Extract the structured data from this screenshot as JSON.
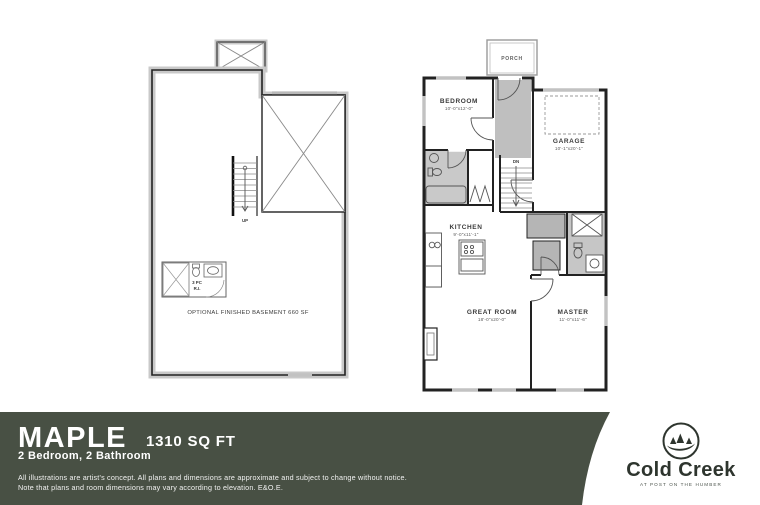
{
  "footer": {
    "model_name": "MAPLE",
    "sqft": "1310 SQ FT",
    "config": "2 Bedroom, 2 Bathroom",
    "disclaimer_line1": "All illustrations are artist's concept. All plans and dimensions are approximate and subject to change without notice.",
    "disclaimer_line2": "Note that plans and room dimensions may vary according to elevation. E&O.E."
  },
  "brand": {
    "name": "Cold Creek",
    "tagline": "AT POST ON THE HUMBER"
  },
  "basement_plan": {
    "bath_line1": "3 PC",
    "bath_line2": "R.I.",
    "stairs_label": "UP",
    "note": "OPTIONAL FINISHED BASEMENT 660 SF"
  },
  "main_plan": {
    "porch_label": "PORCH",
    "stairs_label": "DN",
    "rooms": {
      "bedroom": {
        "name": "BEDROOM",
        "dims": "10'-0\"x12'-0\""
      },
      "garage": {
        "name": "GARAGE",
        "dims": "10'-1\"x20'-1\""
      },
      "kitchen": {
        "name": "KITCHEN",
        "dims": "9'-0\"x11'-1\""
      },
      "great_room": {
        "name": "GREAT ROOM",
        "dims": "18'-0\"x20'-0\""
      },
      "master": {
        "name": "MASTER",
        "dims": "11'-0\"x11'-6\""
      }
    }
  },
  "colors": {
    "footer_band": "#485044",
    "plan_wall": "#222222",
    "plan_shade": "#bdbdbd",
    "wall_hatch": "#c9c9c9",
    "logo_ink": "#2e352e"
  }
}
